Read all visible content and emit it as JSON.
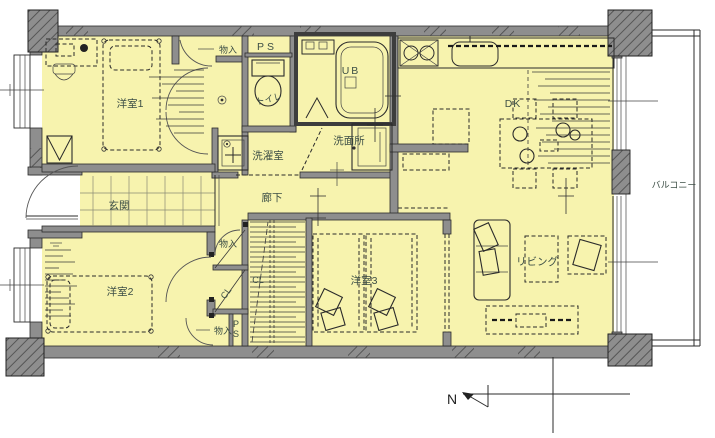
{
  "floorplan": {
    "labels": {
      "room1": "洋室1",
      "room2": "洋室2",
      "room3": "洋室3",
      "entrance": "玄関",
      "hallway": "廊下",
      "living": "リビング",
      "dining_kitchen": "DK",
      "balcony": "バルコニー",
      "washroom": "洗面所",
      "laundry": "洗濯室",
      "toilet": "トイレ",
      "bath": "UB",
      "pipe_space_top": "PS",
      "storage_top": "物入",
      "storage_mid": "物入",
      "storage_bottom": "物入",
      "closet_main": "CL",
      "closet_small": "CL",
      "pipe_space_bottom_p": "P",
      "pipe_space_bottom_s": "S",
      "compass_north": "N"
    },
    "colors": {
      "floor": "#f7f3ae",
      "wall": "#8e8e8e",
      "line": "#2b2b2b",
      "label_text": "#3d4f46",
      "background": "#ffffff"
    }
  }
}
